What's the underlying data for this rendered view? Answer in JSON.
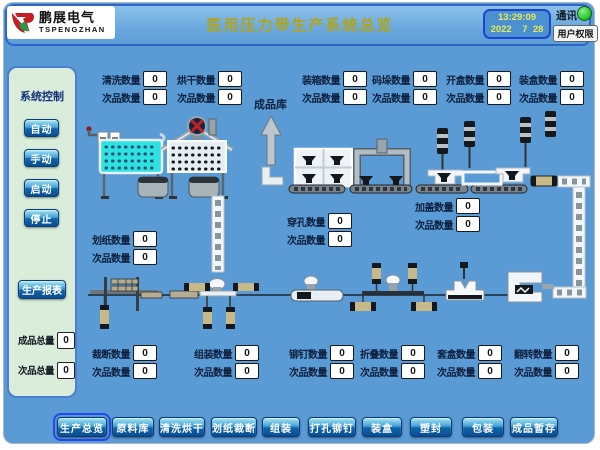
{
  "header": {
    "logo_cn": "鹏展电气",
    "logo_en": "TSPENGZHAN",
    "title": "医用压力带生产系统总览",
    "time": "13:29:09",
    "date": "2022    7  28",
    "comm_label": "通讯",
    "user_button": "用户权限"
  },
  "status": {
    "comm_color": "#2ecc2e",
    "bg_color": "#5b9bd5",
    "title_color": "#b2a419"
  },
  "icons": {
    "comm_indicator": "green-circle",
    "warehouse_arrow": "up-arrow",
    "logo_mark": "pengzhan-swoosh"
  },
  "sidebar": {
    "title": "系统控制",
    "buttons": [
      {
        "label": "自动"
      },
      {
        "label": "手动"
      },
      {
        "label": "启动"
      },
      {
        "label": "停止"
      }
    ],
    "report_button": "生产报表",
    "totals": [
      {
        "label": "成品总量",
        "value": "0"
      },
      {
        "label": "次品总量",
        "value": "0"
      }
    ]
  },
  "labels": {
    "warehouse": "成品库"
  },
  "counters": {
    "top": [
      {
        "label": "清洗数量",
        "value": "0",
        "sub_label": "次品数量",
        "sub_value": "0"
      },
      {
        "label": "烘干数量",
        "value": "0",
        "sub_label": "次品数量",
        "sub_value": "0"
      },
      {
        "label": "装箱数量",
        "value": "0",
        "sub_label": "次品数量",
        "sub_value": "0"
      },
      {
        "label": "码垛数量",
        "value": "0",
        "sub_label": "次品数量",
        "sub_value": "0"
      },
      {
        "label": "开盒数量",
        "value": "0",
        "sub_label": "次品数量",
        "sub_value": "0"
      },
      {
        "label": "装盒数量",
        "value": "0",
        "sub_label": "次品数量",
        "sub_value": "0"
      }
    ],
    "mid": [
      {
        "label": "划纸数量",
        "value": "0",
        "sub_label": "次品数量",
        "sub_value": "0"
      },
      {
        "label": "穿孔数量",
        "value": "0",
        "sub_label": "次品数量",
        "sub_value": "0"
      },
      {
        "label": "加盖数量",
        "value": "0",
        "sub_label": "次品数量",
        "sub_value": "0"
      }
    ],
    "bottom": [
      {
        "label": "裁断数量",
        "value": "0",
        "sub_label": "次品数量",
        "sub_value": "0"
      },
      {
        "label": "组装数量",
        "value": "0",
        "sub_label": "次品数量",
        "sub_value": "0"
      },
      {
        "label": "铆钉数量",
        "value": "0",
        "sub_label": "次品数量",
        "sub_value": "0"
      },
      {
        "label": "折叠数量",
        "value": "0",
        "sub_label": "次品数量",
        "sub_value": "0"
      },
      {
        "label": "套盒数量",
        "value": "0",
        "sub_label": "次品数量",
        "sub_value": "0"
      },
      {
        "label": "翻转数量",
        "value": "0",
        "sub_label": "次品数量",
        "sub_value": "0"
      }
    ]
  },
  "nav": {
    "items": [
      {
        "label": "生产总览",
        "active": true
      },
      {
        "label": "原料库",
        "active": false
      },
      {
        "label": "清洗烘干",
        "active": false
      },
      {
        "label": "划纸裁断",
        "active": false
      },
      {
        "label": "组装",
        "active": false
      },
      {
        "label": "打孔铆钉",
        "active": false
      },
      {
        "label": "装盒",
        "active": false
      },
      {
        "label": "塑封",
        "active": false
      },
      {
        "label": "包装",
        "active": false
      },
      {
        "label": "成品暂存",
        "active": false
      }
    ]
  }
}
